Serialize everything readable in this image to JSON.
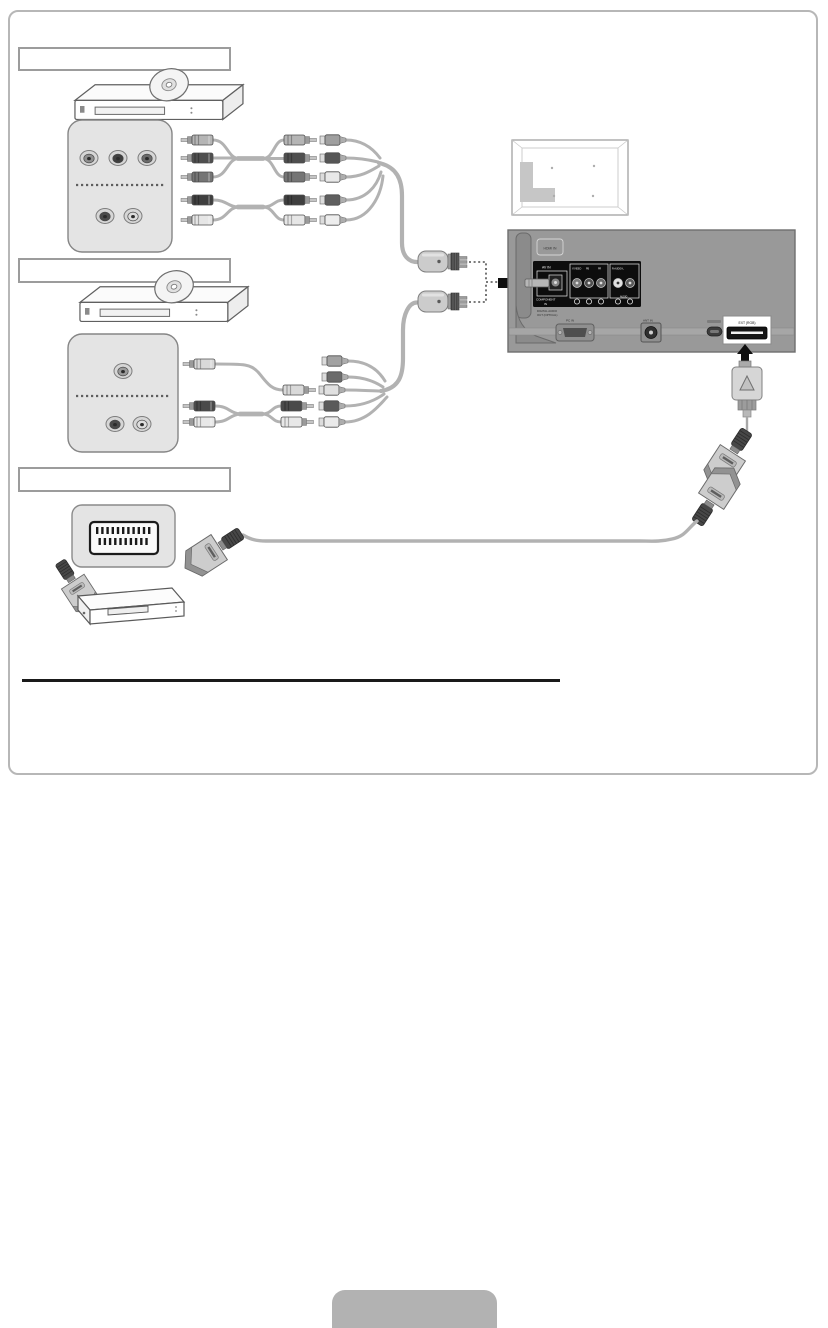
{
  "page": {
    "background_color": "#ffffff",
    "frame_border_color": "#b7b7b7",
    "divider_color": "#1a1a1a",
    "footer_tab_color": "#b2b2b2",
    "footer_tab_label": ""
  },
  "sections": [
    {
      "id": "section-1-component",
      "title": ""
    },
    {
      "id": "section-2-composite",
      "title": ""
    },
    {
      "id": "section-3-scart",
      "title": ""
    }
  ],
  "tv_rear": {
    "hdmi_label": "HDMI IN",
    "panel": {
      "av_in": "AV IN",
      "y_video": "Y/VIDEO",
      "pb": "PB",
      "pr": "PR",
      "audio_top": "R-AUDIO-L",
      "component_in_line1": "COMPONENT",
      "component_in_line2": "IN",
      "audio_bottom": "AUDIO"
    },
    "digital_audio_out_line1": "DIGITAL AUDIO",
    "digital_audio_out_line2": "OUT (OPTICAL)",
    "pc_in": "PC IN",
    "ant_in": "ANT IN",
    "ext_rgb": "EXT (RGB)"
  },
  "icons": {
    "connection_arrow_right": "right-pointing connection arrow",
    "connection_arrow_up": "up-pointing connection arrow",
    "adapter_triangle": "triangle mark on adapter plug"
  },
  "colors": {
    "cable": "#b2b2b2",
    "panel_fill": "#e4e4e4",
    "tv_body": "#999999",
    "connector_black_panel": "#0d0d0d"
  }
}
